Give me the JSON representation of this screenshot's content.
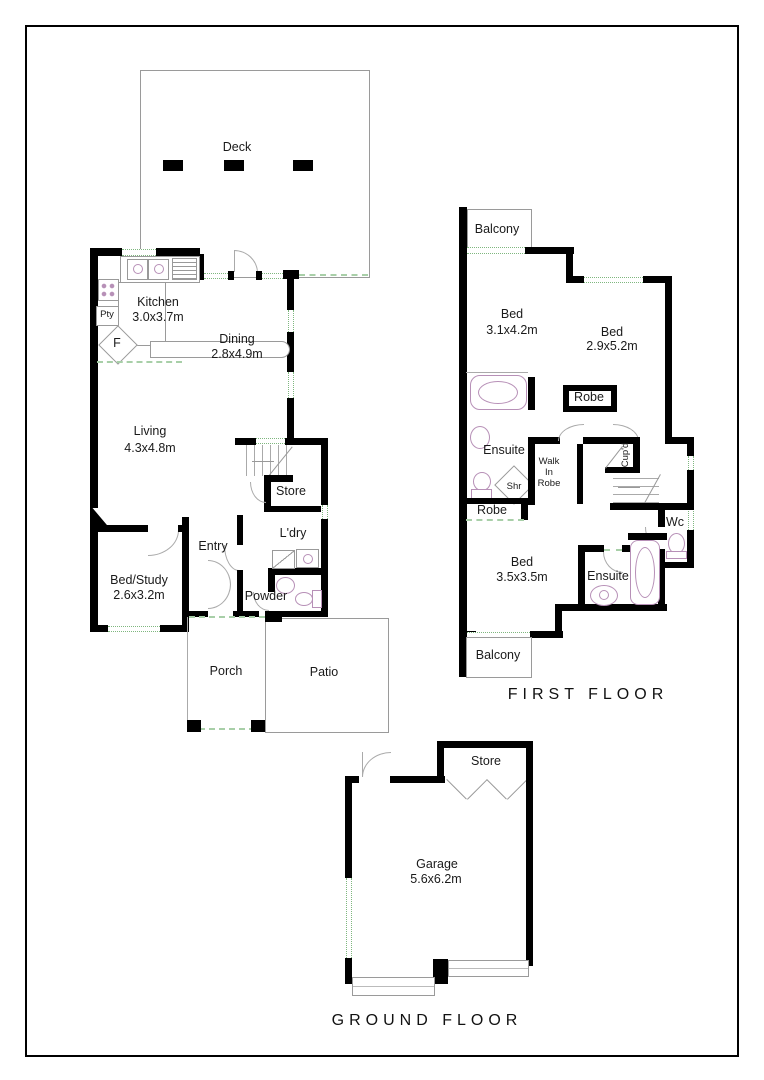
{
  "plan": {
    "titles": {
      "first_floor": "FIRST FLOOR",
      "ground_floor": "GROUND FLOOR"
    },
    "ground_floor": {
      "deck": "Deck",
      "kitchen": {
        "name": "Kitchen",
        "dims": "3.0x3.7m"
      },
      "pantry": "Pty",
      "fridge": "F",
      "dining": {
        "name": "Dining",
        "dims": "2.8x4.9m"
      },
      "living": {
        "name": "Living",
        "dims": "4.3x4.8m"
      },
      "store": "Store",
      "laundry": "L'dry",
      "entry": "Entry",
      "bed_study": {
        "name": "Bed/Study",
        "dims": "2.6x3.2m"
      },
      "powder": "Powder",
      "porch": "Porch",
      "patio": "Patio"
    },
    "first_floor": {
      "balcony_top": "Balcony",
      "bed1": {
        "name": "Bed",
        "dims": "3.1x4.2m"
      },
      "bed2": {
        "name": "Bed",
        "dims": "2.9x5.2m"
      },
      "robe_box": "Robe",
      "ensuite1": "Ensuite",
      "walk_in_robe": {
        "l1": "Walk",
        "l2": "In",
        "l3": "Robe"
      },
      "shower": "Shr",
      "cupboard": "Cup'd",
      "robe_strip": "Robe",
      "wc": "Wc",
      "bed3": {
        "name": "Bed",
        "dims": "3.5x3.5m"
      },
      "ensuite2": "Ensuite",
      "balcony_bottom": "Balcony"
    },
    "garage_block": {
      "store": "Store",
      "garage": {
        "name": "Garage",
        "dims": "5.6x6.2m"
      }
    },
    "colors": {
      "wall": "#000000",
      "line": "#999999",
      "window": "#7fb77f",
      "fixture": "#b790b7"
    }
  }
}
